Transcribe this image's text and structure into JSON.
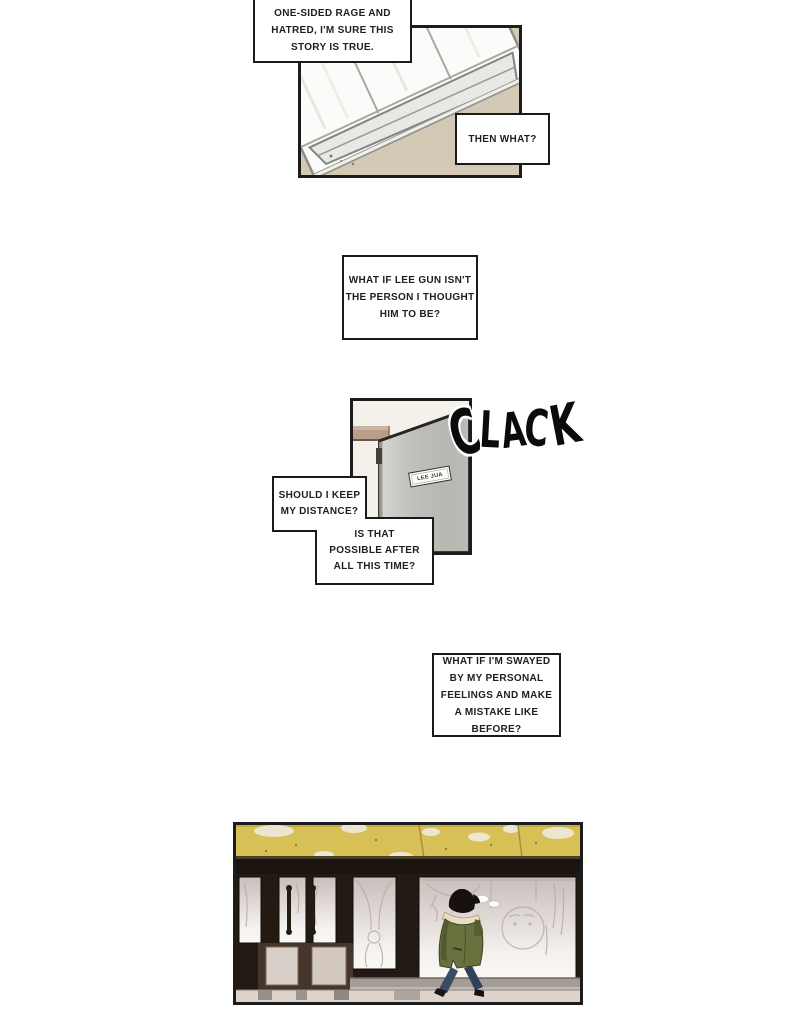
{
  "comic": {
    "thoughts": {
      "box1": "ONE-SIDED RAGE AND\nHATRED, I'M SURE THIS\nSTORY IS TRUE.",
      "box2": "THEN WHAT?",
      "box3": "WHAT IF LEE GUN ISN'T\nTHE PERSON I THOUGHT\nHIM TO BE?",
      "box4": "SHOULD I KEEP\nMY DISTANCE?",
      "box5": "IS THAT\nPOSSIBLE AFTER\nALL THIS TIME?",
      "box6": "WHAT IF I'M SWAYED\nBY MY PERSONAL\nFEELINGS AND MAKE\nA MISTAKE LIKE\nBEFORE?"
    },
    "sfx": {
      "clack": "CLACK",
      "letters": [
        "C",
        "L",
        "A",
        "C",
        "K"
      ]
    },
    "door_nameplate": "LEE JUA",
    "colors": {
      "panel_border": "#1c1c1c",
      "wall_beige": "#d4c9b5",
      "door_gray": "#cac9c3",
      "interior_wall": "#f4f1eb",
      "awning_yellow": "#d7c055",
      "storefront_dark": "#231a13",
      "glass_light": "#f4f1ee",
      "parka_green": "#6a713e",
      "fur_trim": "#e8dfc0",
      "jeans_blue": "#3a4b64"
    }
  }
}
